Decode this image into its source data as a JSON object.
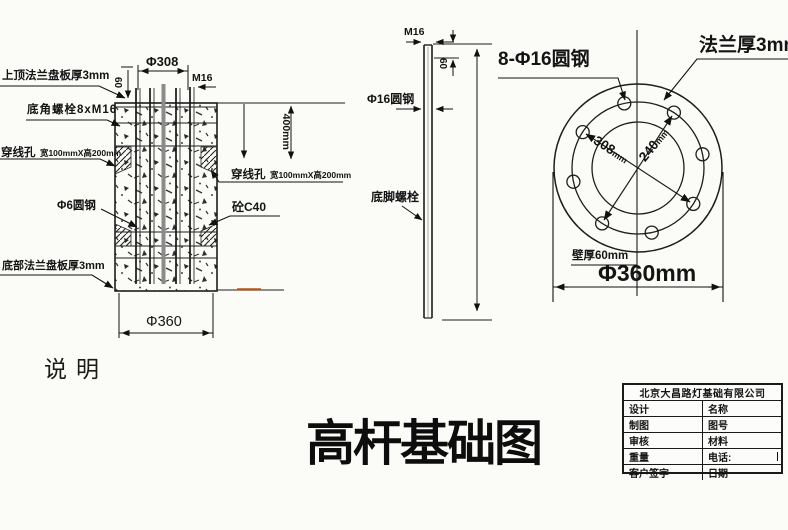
{
  "drawing_title": "高杆基础图",
  "notes_label": "说明",
  "section_view": {
    "top_flange_label": "上顶法兰盘板厚3mm",
    "anchor_bolt_label": "底角螺栓8xM16",
    "wire_hole_label_left": "穿线孔",
    "wire_hole_size_left": "宽100mmX高200mm",
    "rebar_label": "Φ6圆钢",
    "bottom_flange_label": "底部法兰盘板厚3mm",
    "wire_hole_label_right": "穿线孔",
    "wire_hole_size_right": "宽100mmX高200mm",
    "concrete_label": "砼C40",
    "dim_bolt_circle": "Φ308",
    "dim_thread": "M16",
    "dim_protrusion": "60",
    "dim_hole_depth": "400mm",
    "dim_base_diameter": "Φ360"
  },
  "bolt_view": {
    "dim_thread": "M16",
    "dim_top": "60",
    "rod_label": "Φ16圆钢",
    "anchor_label": "底脚螺栓"
  },
  "flange_view": {
    "bolt_pattern_label": "8-Φ16圆钢",
    "flange_thickness_label": "法兰厚3mm",
    "dim_bolt_circle_value": "308",
    "dim_bolt_circle_unit": "mm",
    "dim_inner_value": "240",
    "dim_inner_unit": "mm",
    "wall_thickness_label": "壁厚60mm",
    "dim_outer_diameter": "Φ360mm"
  },
  "title_block": {
    "company": "北京大昌路灯基础有限公司",
    "rows": [
      {
        "left": "设计",
        "right": "名称"
      },
      {
        "left": "制图",
        "right": "图号"
      },
      {
        "left": "审核",
        "right": "材料"
      },
      {
        "left": "重量",
        "right": "电话:"
      },
      {
        "left": "客户签字",
        "right": "日期"
      }
    ]
  }
}
